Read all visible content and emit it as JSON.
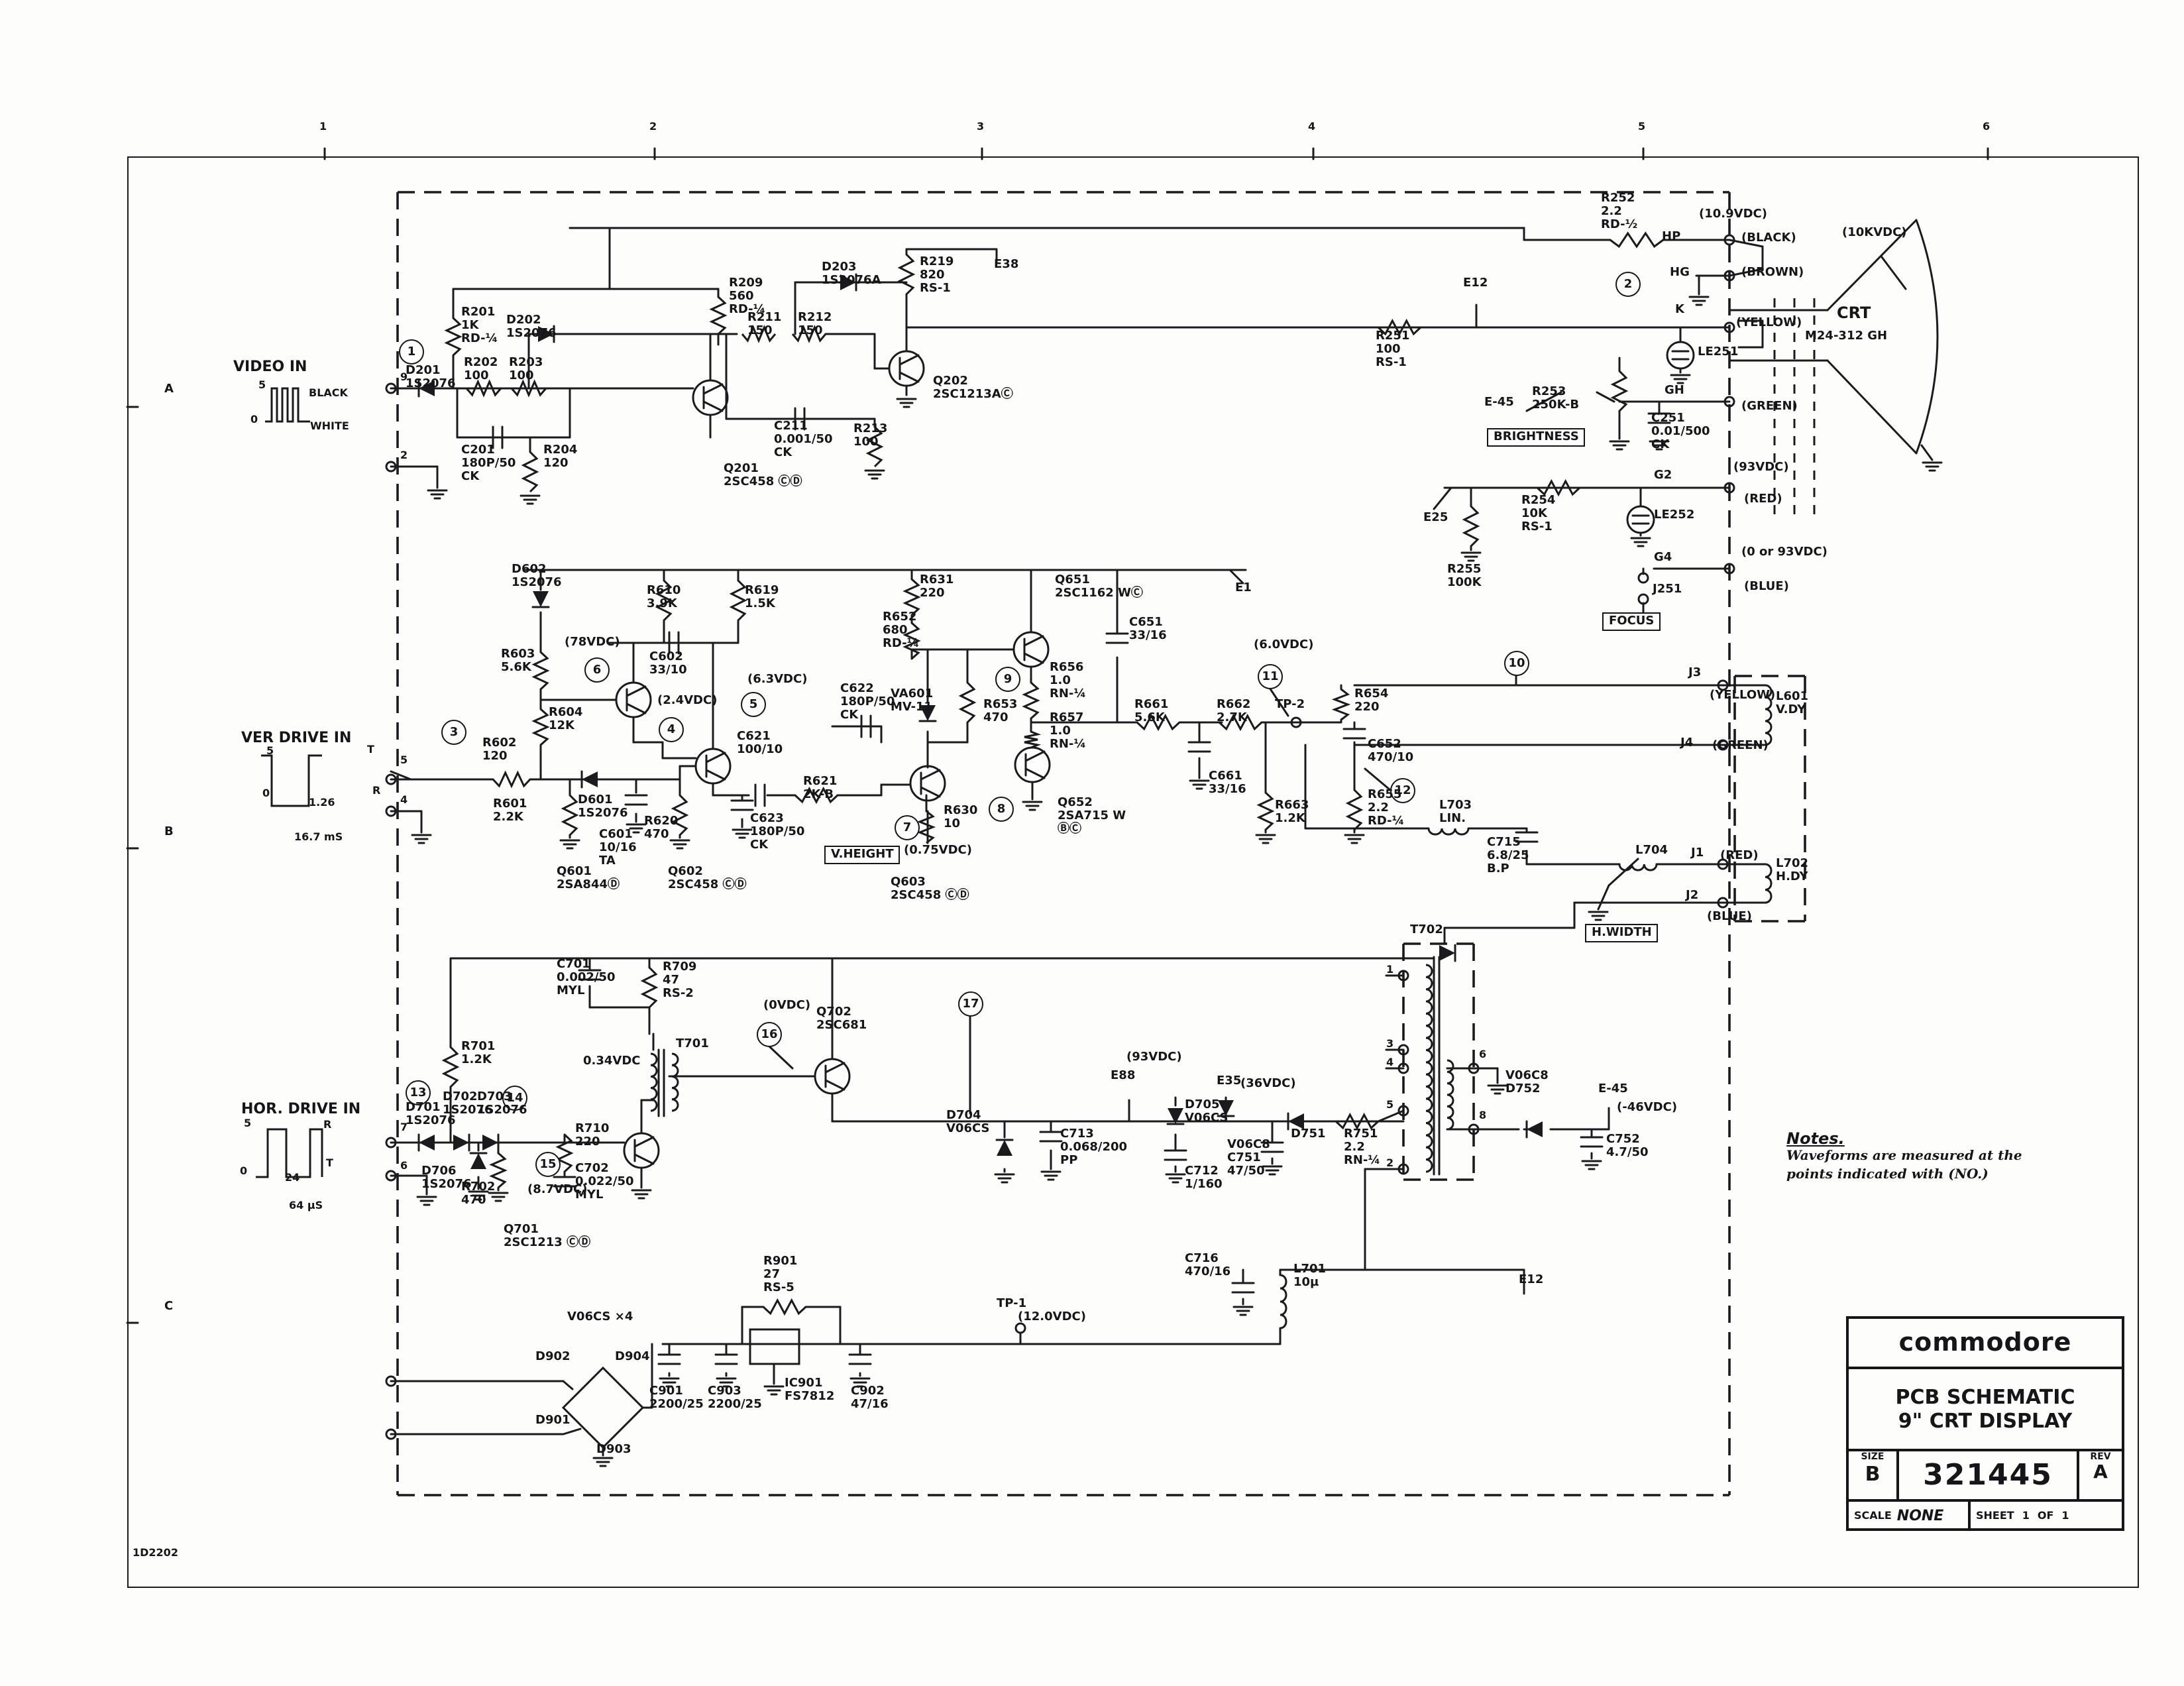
{
  "title_block": {
    "brand": "commodore",
    "title_line1": "PCB SCHEMATIC",
    "title_line2": "9\" CRT DISPLAY",
    "size_label": "SIZE",
    "size": "B",
    "drawing_number": "321445",
    "rev_label": "REV",
    "rev": "A",
    "scale_label": "SCALE",
    "scale": "NONE",
    "sheet_label": "SHEET",
    "sheet": "1",
    "of_label": "OF",
    "of": "1"
  },
  "notes": {
    "title": "Notes.",
    "line1": "Waveforms are measured at the",
    "line2": "points indicated with (NO.)"
  },
  "ruler": {
    "top": [
      "1",
      "2",
      "3",
      "4",
      "5",
      "6"
    ],
    "side": [
      "A",
      "B",
      "C"
    ],
    "doc": "1D2202"
  },
  "wp": [
    "1",
    "2",
    "3",
    "4",
    "5",
    "6",
    "7",
    "8",
    "9",
    "10",
    "11",
    "12",
    "13",
    "14",
    "15",
    "16",
    "17"
  ],
  "inputs": {
    "video": {
      "title": "VIDEO IN",
      "lv5": "5",
      "lv0": "0",
      "black": "BLACK",
      "white": "WHITE",
      "pin_a": "9",
      "pin_b": "2"
    },
    "ver": {
      "title": "VER DRIVE IN",
      "lv5": "5",
      "lv0": "0",
      "w1": "1.26",
      "per": "16.7 mS",
      "t": "T",
      "r": "R",
      "pin_a": "5",
      "pin_b": "4"
    },
    "hor": {
      "title": "HOR. DRIVE IN",
      "lv5": "5",
      "lv0": "0",
      "w1": "24",
      "per": "64 µS",
      "t": "T",
      "r": "R",
      "pin_a": "7",
      "pin_b": "6"
    }
  },
  "crt": {
    "name": "CRT",
    "model": "M24-312 GH",
    "anode": "(10KVDC)"
  },
  "pins": {
    "p1": "1",
    "p2": "2",
    "p3": "3",
    "p4": "4",
    "p5": "5",
    "p6": "6",
    "p8": "8"
  },
  "c": {
    "d201": "D201\n1S2076",
    "r201": "R201\n1K\nRD-¼",
    "d202": "D202\n1S2076",
    "r202": "R202\n100",
    "r203": "R203\n100",
    "c201": "C201\n180P/50\nCK",
    "r204": "R204\n120",
    "q201": "Q201\n2SC458 ⒸⒹ",
    "r209": "R209\n560\nRD-¼",
    "r211": "R211\n150",
    "r212": "R212\n150",
    "d203": "D203\n1S2076A",
    "c211": "C211\n0.001/50\nCK",
    "r213": "R213\n100",
    "r219": "R219\n820\nRS-1",
    "e38": "E38",
    "q202": "Q202\n2SC1213AⒸ",
    "e12": "E12",
    "r251": "R251\n100\nRS-1",
    "r252": "R252\n2.2\nRD-½",
    "hp": "HP",
    "v109": "(10.9VDC)",
    "blk": "(BLACK)",
    "hg": "HG",
    "brn": "(BROWN)",
    "k": "K",
    "le251": "LE251",
    "yel": "(YELLOW)",
    "e45": "E-45",
    "r253": "R253\n250K-B",
    "c251": "C251\n0.01/500\nCK",
    "gh": "GH",
    "grn": "(GREEN)",
    "g2": "G2",
    "v93": "(93VDC)",
    "red": "(RED)",
    "e25": "E25",
    "r254": "R254\n10K\nRS-1",
    "le252": "LE252",
    "r255": "R255\n100K",
    "g4": "G4",
    "v093": "(0 or 93VDC)",
    "blu": "(BLUE)",
    "j251": "J251",
    "brightness": "BRIGHTNESS",
    "focus": "FOCUS",
    "d602": "D602\n1S2076",
    "r610": "R610\n3.9K",
    "r619": "R619\n1.5K",
    "r603": "R603\n5.6K",
    "v78": "(78VDC)",
    "c602": "C602\n33/10",
    "v63": "(6.3VDC)",
    "v24": "(2.4VDC)",
    "r604": "R604\n12K",
    "r602": "R602\n120",
    "r601": "R601\n2.2K",
    "d601": "D601\n1S2076",
    "c601": "C601\n10/16\nTA",
    "q601": "Q601\n2SA844Ⓓ",
    "q602": "Q602\n2SC458 ⒸⒹ",
    "c621": "C621\n100/10",
    "c622": "C622\n180P/50\nCK",
    "c623": "C623\n180P/50\nCK",
    "r620": "R620\n470",
    "r621": "R621\n2K-B",
    "vheight": "V.HEIGHT",
    "v075": "(0.75VDC)",
    "q603": "Q603\n2SC458 ⒸⒹ",
    "r630": "R630\n10",
    "r631": "R631\n220",
    "r652": "R652\n680\nRD-¼",
    "q651": "Q651\n2SC1162 WⒸ",
    "va601": "VA601\nMV-11",
    "r653": "R653\n470",
    "r656": "R656\n1.0\nRN-¼",
    "c651": "C651\n33/16",
    "r657": "R657\n1.0\nRN-¼",
    "q652": "Q652\n2SA715 W\nⒷⒸ",
    "v60": "(6.0VDC)",
    "tp2": "TP-2",
    "r661": "R661\n5.6K",
    "r662": "R662\n2.7K",
    "c661": "C661\n33/16",
    "r663": "R663\n1.2K",
    "c652": "C652\n470/10",
    "r654": "R654\n220",
    "r655": "R655\n2.2\nRD-¼",
    "e1": "E1",
    "j3": "J3",
    "yel2": "(YELLOW)",
    "l601": "L601\nV.DY",
    "j4": "J4",
    "grn2": "(GREEN)",
    "l703": "L703\nLIN.",
    "c715": "C715\n6.8/25\nB.P",
    "l704": "L704",
    "j1": "J1",
    "red2": "(RED)",
    "l702": "L702\nH.DY",
    "j2": "J2",
    "blu2": "(BLUE)",
    "hwidth": "H.WIDTH",
    "c701": "C701\n0.002/50\nMYL",
    "r709": "R709\n47\nRS-2",
    "t701": "T701",
    "r701": "R701\n1.2K",
    "v034": "0.34VDC",
    "d701": "D701\n1S2076",
    "d702": "D702\n1S2076",
    "d703": "D703\n1S2076",
    "d706": "D706\n1S2076",
    "r702": "R702\n470",
    "v87": "(8.7VDC)",
    "q701": "Q701\n2SC1213 ⒸⒹ",
    "r710": "R710\n220",
    "c702": "C702\n0.022/50\nMYL",
    "v0": "(0VDC)",
    "q702": "Q702\n2SC681",
    "d704": "D704\nV06CS",
    "c713": "C713\n0.068/200\nPP",
    "e88": "E88",
    "v93b": "(93VDC)",
    "d705": "D705\nV06CS",
    "c712": "C712\n1/160",
    "e35": "E35",
    "v36": "(36VDC)",
    "d751": "D751",
    "r751": "R751\n2.2\nRN-¼",
    "c751": "V06C8\nC751\n47/50",
    "t702": "T702",
    "d752": "V06C8\nD752",
    "e45b": "E-45",
    "v46": "(-46VDC)",
    "c752": "C752\n4.7/50",
    "v06cs4": "V06CS ×4",
    "d902": "D902",
    "d904": "D904",
    "d901": "D901",
    "d903": "D903",
    "c901": "C901\n2200/25",
    "c903": "C903\n2200/25",
    "r901": "R901\n27\nRS-5",
    "ic901": "IC901\nFS7812",
    "c902": "C902\n47/16",
    "tp1": "TP-1",
    "v120": "(12.0VDC)",
    "c716": "C716\n470/16",
    "l701": "L701\n10µ",
    "e12b": "E12"
  }
}
